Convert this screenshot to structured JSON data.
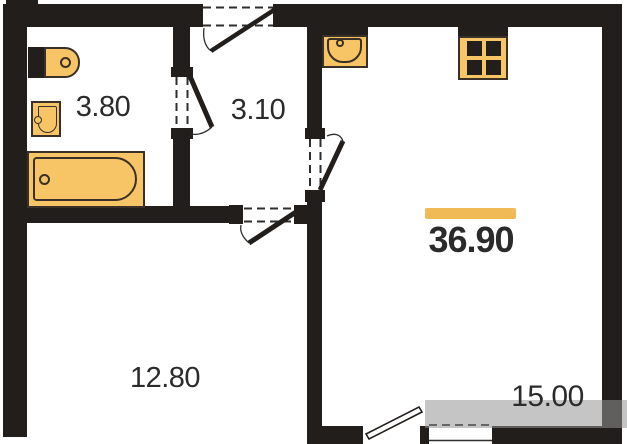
{
  "plan": {
    "total_area": "36.90",
    "rooms": [
      {
        "id": "bathroom",
        "area": "3.80"
      },
      {
        "id": "hallway",
        "area": "3.10"
      },
      {
        "id": "room-left",
        "area": "12.80"
      },
      {
        "id": "room-right",
        "area": "15.00"
      }
    ]
  },
  "icons": [
    "toilet-icon",
    "wash-basin-icon",
    "bathtub-icon",
    "kitchen-sink-icon",
    "stove-icon",
    "door-swing-icon",
    "balcony-door-icon"
  ],
  "colors": {
    "bg": "#ffffff",
    "wall": "#211e1c",
    "fixture-fill": "#f7c466",
    "fixture-border": "#3a3027",
    "accent-bar": "#f0ba57",
    "text": "#2b2b2b",
    "watermark": "rgba(150,150,150,0.55)"
  }
}
